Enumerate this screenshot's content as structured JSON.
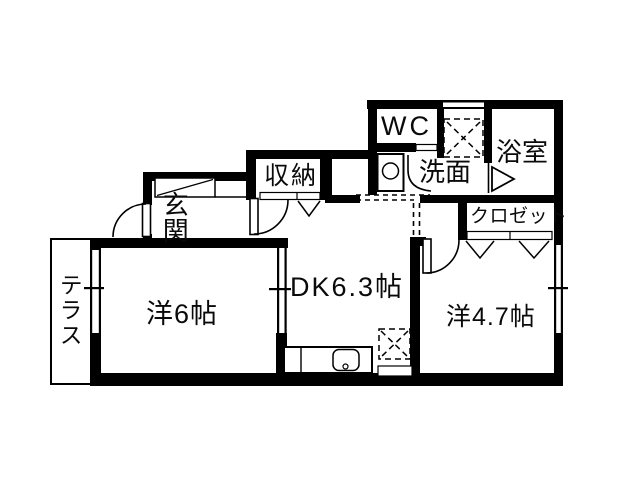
{
  "plan": {
    "title": "apartment-floor-plan",
    "rooms": {
      "entrance": {
        "label": "玄関"
      },
      "storage": {
        "label": "収納"
      },
      "wc": {
        "label": "WC"
      },
      "washroom": {
        "label": "洗面"
      },
      "bathroom": {
        "label": "浴室"
      },
      "closet": {
        "label": "クロゼット"
      },
      "terrace": {
        "label": "テラス"
      },
      "western_room_6": {
        "label": "洋6帖"
      },
      "dining_kitchen": {
        "label": "DK6.3帖"
      },
      "western_room_47": {
        "label": "洋4.7帖"
      }
    },
    "symbols": [
      "front-door-swing",
      "interior-door-swing",
      "wc-door-swing",
      "bathroom-folding-door",
      "bifold-closet-door",
      "shoe-cabinet",
      "washing-machine",
      "washer-pan-dashed",
      "refrigerator-space-dashed",
      "kitchen-counter-with-sink",
      "window",
      "terrace-outline"
    ],
    "colors": {
      "wall": "#000000",
      "background": "#ffffff",
      "text": "#0a0a0a"
    }
  }
}
